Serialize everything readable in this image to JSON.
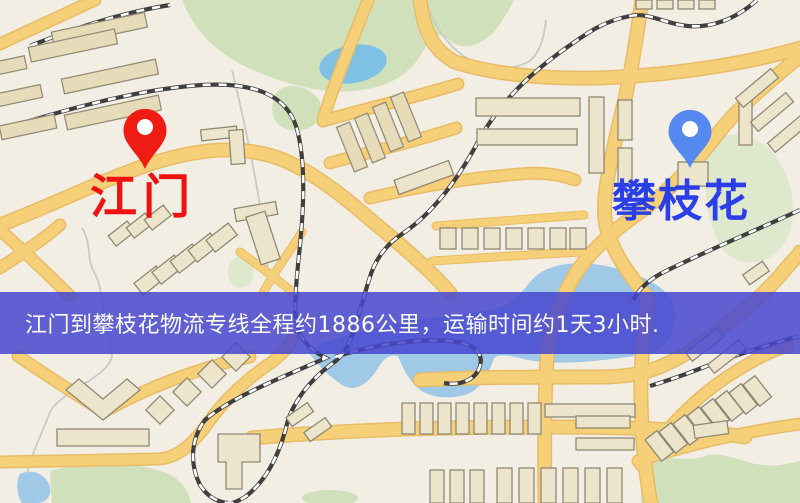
{
  "banner": {
    "text": "江门到攀枝花物流专线全程约1886公里，运输时间约1天3小时.",
    "bg_color": "#4747d0",
    "bg_opacity": 0.85,
    "text_color": "#fcfcf5"
  },
  "markers": [
    {
      "id": "origin",
      "label": "江门",
      "pin_color": "#ee1c12",
      "label_color": "#f01111"
    },
    {
      "id": "destination",
      "label": "攀枝花",
      "pin_color": "#5589f0",
      "label_color": "#2a3fe8"
    }
  ],
  "map": {
    "palette": {
      "background": "#f2eee3",
      "road": "#f5d079",
      "road_casing": "#e8bc66",
      "building_fill": "#ede5cb",
      "building_fill_dark": "#e6dcba",
      "building_stroke": "#8f8874",
      "park": "#cfe0ba",
      "park_light": "#dde8cc",
      "water": "#9fc9e7",
      "lake": "#7fc0e5",
      "railway": "#3f3f3f",
      "stream": "#c6ccc4"
    }
  }
}
